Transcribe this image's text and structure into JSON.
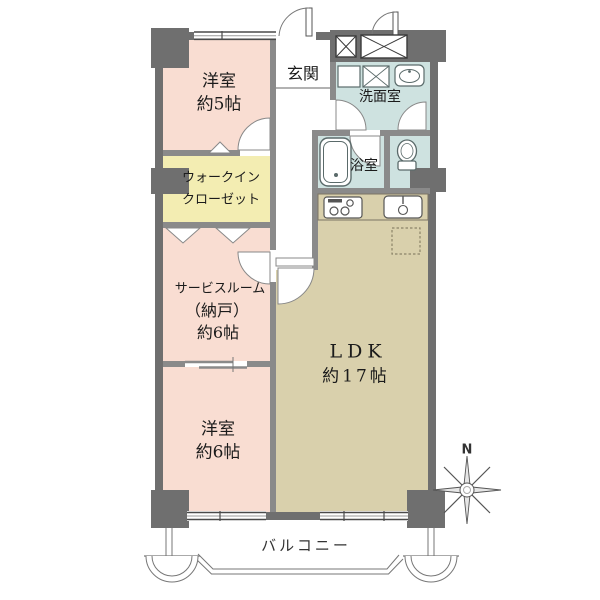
{
  "plan": {
    "rooms": {
      "western5": {
        "name": "洋室",
        "size": "約5帖"
      },
      "entrance": {
        "name": "玄関"
      },
      "washroom": {
        "name": "洗面室"
      },
      "walkin_closet": {
        "name_line1": "ウォークイン",
        "name_line2": "クローゼット"
      },
      "bathroom": {
        "name": "浴室"
      },
      "service_room": {
        "name": "サービスルーム",
        "sub": "（納戸）",
        "size": "約6帖"
      },
      "ldk": {
        "name": "LDK",
        "size": "約17帖"
      },
      "western6": {
        "name": "洋室",
        "size": "約6帖"
      },
      "balcony": {
        "name": "バルコニー"
      }
    },
    "compass": {
      "north_label": "N"
    },
    "colors": {
      "room_pink": "#f9ddd2",
      "closet_yellow": "#f3edb2",
      "wet_area_blue": "#cee2e0",
      "ldk_tan": "#d9d0ac",
      "structure_wall": "#6f6f6f",
      "partition_wall": "#8a8a8a"
    }
  }
}
